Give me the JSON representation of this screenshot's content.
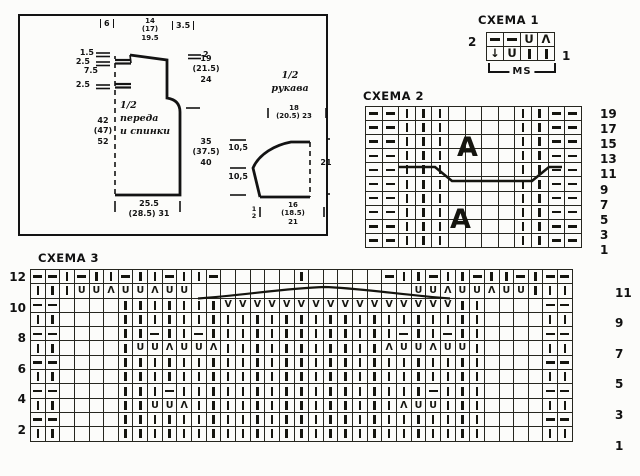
{
  "ink": "#131313",
  "schematic": {
    "front": {
      "title": "1/2\nпереда\nи спинки",
      "shoulder": "6",
      "neck": "14\n(17)\n19.5",
      "slant": "3.5",
      "tick2": "2",
      "armhole": "19\n(21.5)\n24",
      "side": "35\n(37.5)\n40",
      "l1": "1.5",
      "l2": "2.5",
      "l3": "7.5",
      "l4": "2.5",
      "length": "42\n(47)\n52",
      "bottom": "25.5\n(28.5) 31"
    },
    "sleeve": {
      "title": "1/2\nрукава",
      "top": "18\n(20.5) 23",
      "left1": "10,5",
      "left2": "10,5",
      "right": "21",
      "bottom": "16\n(18.5)\n21",
      "half": "1\n2"
    }
  },
  "symbols": {
    "-": "purl",
    "l": "knit",
    "U": "U",
    "A": "Λ",
    "V": "V",
    "d": "↓",
    ".": ""
  },
  "charts": {
    "schema1": {
      "heading": "СХЕМА 1",
      "left_label": "2",
      "right_label": "1",
      "bracket": "MS",
      "rows": [
        "- - U A",
        "d U l l"
      ]
    },
    "schema2": {
      "heading": "СХЕМА 2",
      "right_labels": [
        "19",
        "17",
        "15",
        "13",
        "11",
        "9",
        "7",
        "5",
        "3",
        "1"
      ],
      "overlay_letters": [
        "A",
        "A"
      ],
      "rows": [
        "- - l l l . . . . l l - -",
        "- - l l l . . . . l l - -",
        "- - l l l . . . . l l - -",
        "- - l l l . . . . l l - -",
        "- - l l l . . . . l l - -",
        "- - l l l . . . . l l - -",
        "- - l l l . . . . l l - -",
        "- - l l l . . . . l l - -",
        "- - l l l . . . . l l - -",
        "- - l l l . . . . l l - -"
      ]
    },
    "schema3": {
      "heading": "СХЕМА 3",
      "left_labels": [
        "12",
        "10",
        "8",
        "6",
        "4",
        "2"
      ],
      "right_labels": [
        "11",
        "9",
        "7",
        "5",
        "3",
        "1"
      ],
      "rows": [
        "- - l - l l - l l - l l - . . . . . l . . . . . - l l - l l - l l - l - -",
        "l l l U U A U U A U U . . . . . . . . . . . . . . . U U A U U A U U l l l",
        "- - . . . . l l l l l l l V V V V V V V V V V V V V V V V l l . . . . - -",
        "l l . . . . l l l l l l l l l l l l l l l l l l l l l l l l l . . . . l l",
        "- - . . . . l l - l l - l l l l l l l l l l l l l - l l - l l . . . . - -",
        "l l . . . . l U U A U U A l l l l l l l l l l l A U U A U U l . . . . l l",
        "- - . . . . l l l l l l l l l l l l l l l l l l l l l l l l l . . . . - -",
        "l l . . . . l l l l l l l l l l l l l l l l l l l l l l l l l . . . . l l",
        "- - . . . . l l l - l l l l l l l l l l l l l l l l l - l l l . . . . - -",
        "l l . . . . l l U U A l l l l l l l l l l l l l l A U U l l l . . . . l l",
        "- - . . . . l l l l l l l l l l l l l l l l l l l l l l l l l . . . . - -",
        "l l . . . . l l l l l l l l l l l l l l l l l l l l l l l l l . . . . l l"
      ]
    }
  }
}
